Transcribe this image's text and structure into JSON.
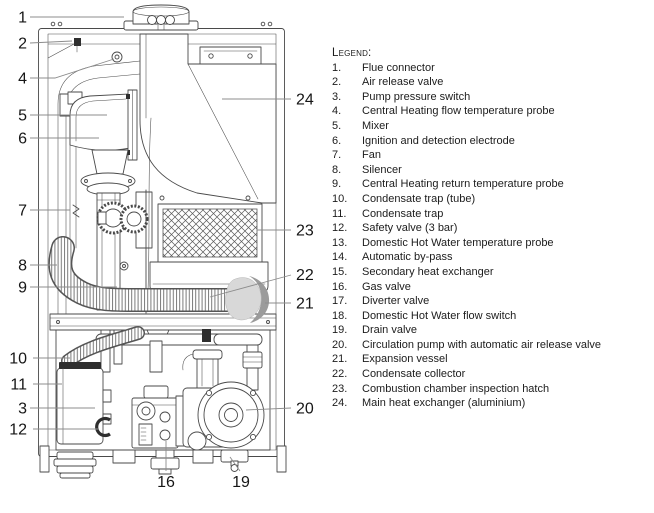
{
  "colors": {
    "line": "#4a4a4a",
    "leader": "#8c8c8c",
    "dark": "#2e2e2e",
    "vessel-light": "#d8d8d8",
    "vessel-shadow": "#9b9b9b",
    "text": "#1c1c1c",
    "background": "#ffffff"
  },
  "diagram": {
    "callouts": {
      "c1": "1",
      "c2": "2",
      "c3": "3",
      "c4": "4",
      "c5": "5",
      "c6": "6",
      "c7": "7",
      "c8": "8",
      "c9": "9",
      "c10": "10",
      "c11": "11",
      "c12": "12",
      "c16": "16",
      "c19": "19",
      "c20": "20",
      "c21": "21",
      "c22": "22",
      "c23": "23",
      "c24": "24"
    }
  },
  "legend": {
    "title": "Legend:",
    "items": [
      {
        "num": "1.",
        "label": "Flue connector"
      },
      {
        "num": "2.",
        "label": "Air release valve"
      },
      {
        "num": "3.",
        "label": "Pump pressure switch"
      },
      {
        "num": "4.",
        "label": "Central Heating flow temperature probe"
      },
      {
        "num": "5.",
        "label": "Mixer"
      },
      {
        "num": "6.",
        "label": "Ignition and detection electrode"
      },
      {
        "num": "7.",
        "label": "Fan"
      },
      {
        "num": "8.",
        "label": "Silencer"
      },
      {
        "num": "9.",
        "label": "Central Heating return temperature probe"
      },
      {
        "num": "10.",
        "label": "Condensate trap (tube)"
      },
      {
        "num": "11.",
        "label": "Condensate trap"
      },
      {
        "num": "12.",
        "label": "Safety valve (3 bar)"
      },
      {
        "num": "13.",
        "label": "Domestic Hot Water temperature probe"
      },
      {
        "num": "14.",
        "label": "Automatic by-pass"
      },
      {
        "num": "15.",
        "label": "Secondary heat exchanger"
      },
      {
        "num": "16.",
        "label": "Gas valve"
      },
      {
        "num": "17.",
        "label": "Diverter valve"
      },
      {
        "num": "18.",
        "label": "Domestic Hot Water flow switch"
      },
      {
        "num": "19.",
        "label": "Drain valve"
      },
      {
        "num": "20.",
        "label": "Circulation pump with automatic air release valve"
      },
      {
        "num": "21.",
        "label": "Expansion vessel"
      },
      {
        "num": "22.",
        "label": "Condensate collector"
      },
      {
        "num": "23.",
        "label": "Combustion chamber inspection hatch"
      },
      {
        "num": "24.",
        "label": "Main heat exchanger (aluminium)"
      }
    ]
  }
}
